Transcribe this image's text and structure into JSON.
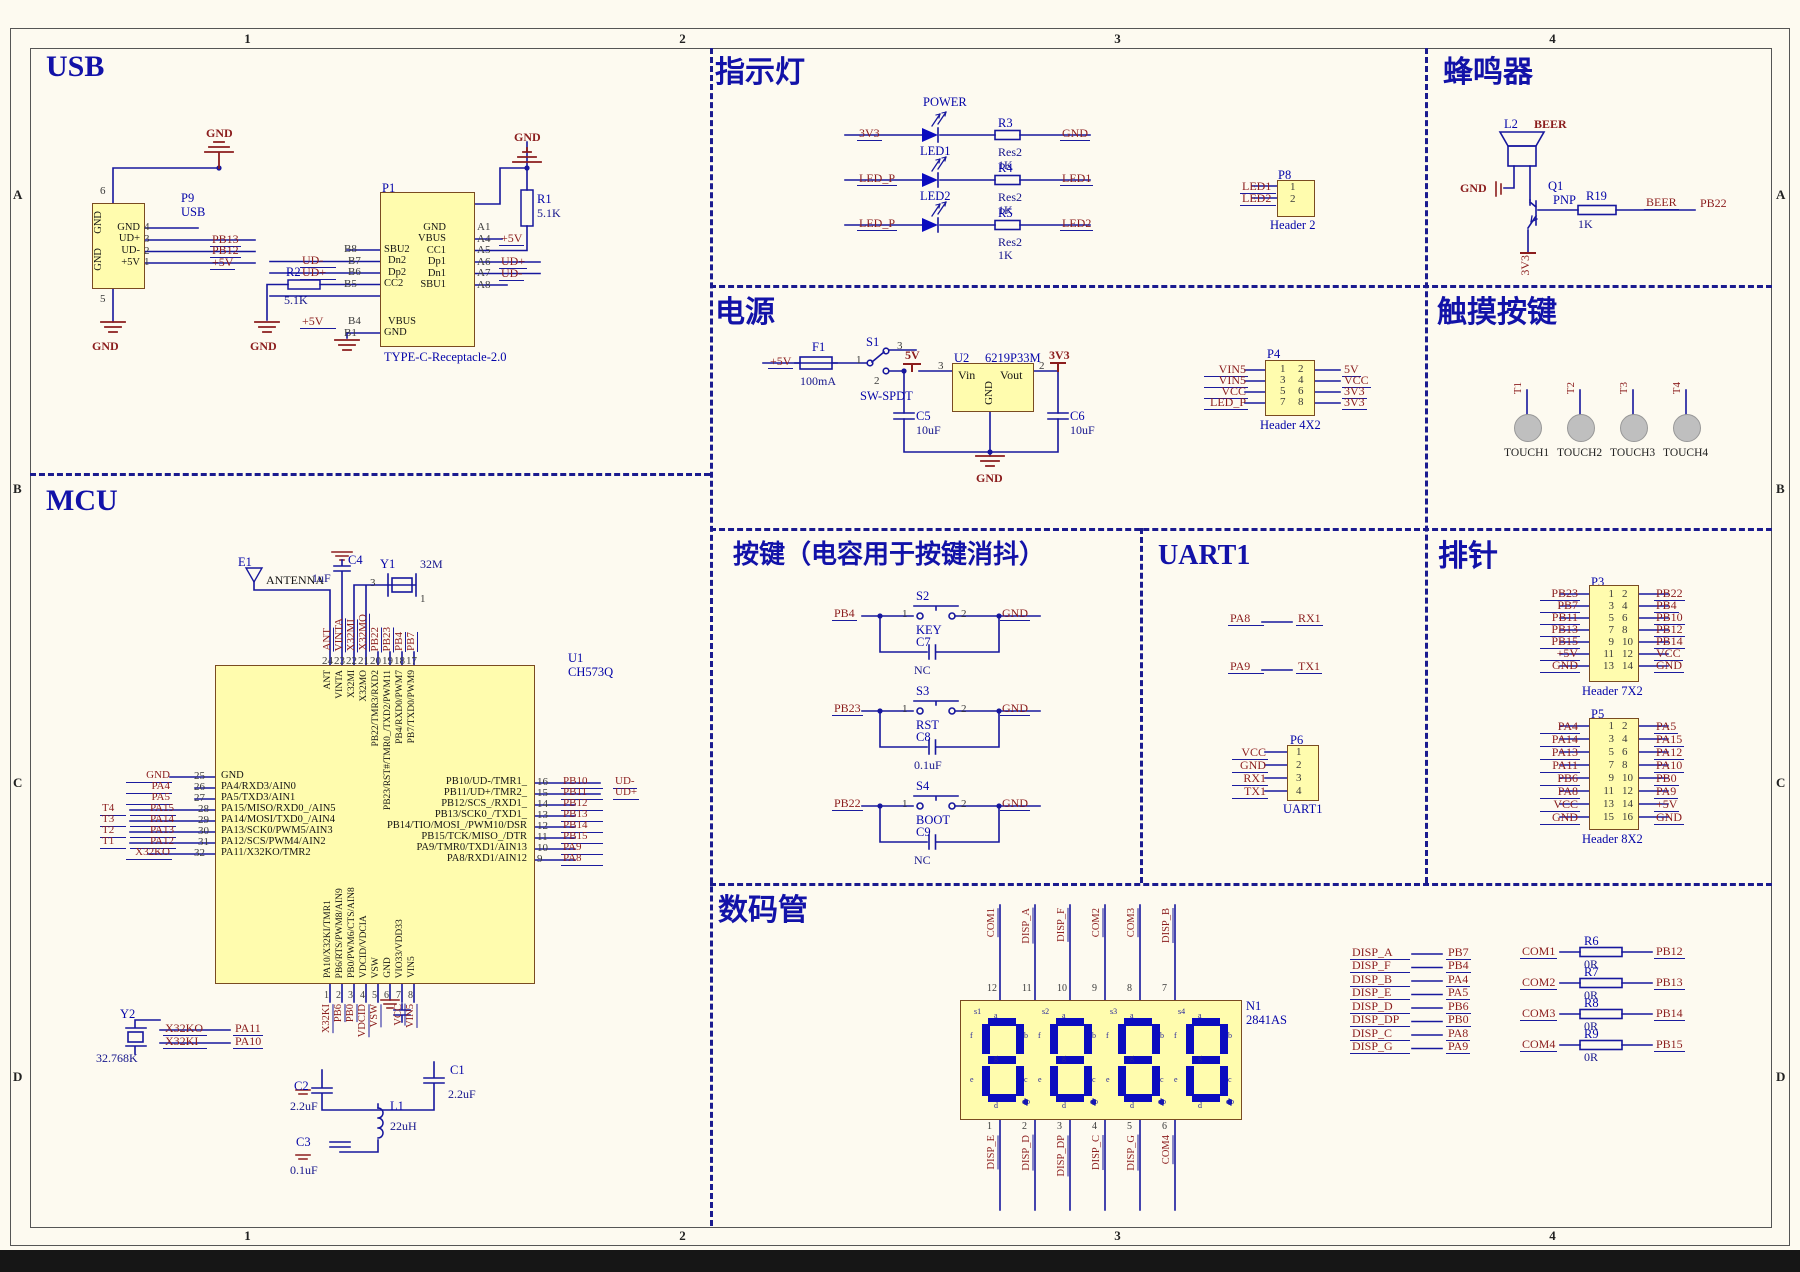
{
  "sheet": {
    "cols": [
      "1",
      "2",
      "3",
      "4"
    ],
    "rows": [
      "A",
      "B",
      "C",
      "D"
    ]
  },
  "usb": {
    "title": "USB",
    "p9": {
      "ref": "P9",
      "name": "USB",
      "pin_top": "6",
      "pin_bottom": "5",
      "side_names": [
        "GND",
        "GND"
      ],
      "rows": [
        {
          "num": "4",
          "pname": "GND",
          "net": ""
        },
        {
          "num": "3",
          "pname": "UD+",
          "net": "PB13"
        },
        {
          "num": "2",
          "pname": "UD-",
          "net": "PB12"
        },
        {
          "num": "1",
          "pname": "+5V",
          "net": "+5V"
        }
      ]
    },
    "gnd": "GND",
    "r2": {
      "ref": "R2",
      "val": "5.1K"
    },
    "r1": {
      "ref": "R1",
      "val": "5.1K"
    },
    "p1": {
      "ref": "P1",
      "footprint": "TYPE-C-Receptacle-2.0",
      "left_rows": [
        {
          "net": "",
          "num": "B8",
          "pname": "SBU2"
        },
        {
          "net": "UD-",
          "num": "B7",
          "pname": "Dn2"
        },
        {
          "net": "UD+",
          "num": "B6",
          "pname": "Dp2"
        },
        {
          "net": "",
          "num": "B5",
          "pname": "CC2"
        },
        {
          "net": "+5V",
          "num": "B4",
          "pname": "VBUS"
        },
        {
          "net": "",
          "num": "B1",
          "pname": "GND"
        }
      ],
      "right_rows": [
        {
          "num": "A1",
          "pname": "GND",
          "net": ""
        },
        {
          "num": "A4",
          "pname": "VBUS",
          "net": "+5V"
        },
        {
          "num": "A5",
          "pname": "CC1",
          "net": ""
        },
        {
          "num": "A6",
          "pname": "Dp1",
          "net": "UD+"
        },
        {
          "num": "A7",
          "pname": "Dn1",
          "net": "UD-"
        },
        {
          "num": "A8",
          "pname": "SBU1",
          "net": ""
        }
      ]
    }
  },
  "indicator": {
    "title": "指示灯",
    "rows": [
      {
        "net_in": "3V3",
        "top_label": "POWER",
        "bot_label": "LED1",
        "res": "R3",
        "res_type": "Res2",
        "res_val": "1K",
        "net_out": "GND"
      },
      {
        "net_in": "LED_P",
        "top_label": "",
        "bot_label": "LED2",
        "res": "R4",
        "res_type": "Res2",
        "res_val": "1K",
        "net_out": "LED1"
      },
      {
        "net_in": "LED_P",
        "top_label": "",
        "bot_label": "",
        "res": "R5",
        "res_type": "Res2",
        "res_val": "1K",
        "net_out": "LED2"
      }
    ],
    "p8": {
      "ref": "P8",
      "label": "Header 2",
      "rows": [
        {
          "net": "LED1",
          "pin": "1"
        },
        {
          "net": "LED2",
          "pin": "2"
        }
      ]
    }
  },
  "buzzer": {
    "title": "蜂鸣器",
    "l2": "L2",
    "l2_net": "BEER",
    "gnd": "GND",
    "q_ref": "Q1",
    "q_type": "PNP",
    "r_ref": "R19",
    "r_val": "1K",
    "net": "BEER",
    "out": "PB22",
    "rail": "3V3"
  },
  "power": {
    "title": "电源",
    "in": "+5V",
    "fuse": {
      "ref": "F1",
      "val": "100mA"
    },
    "sw": {
      "ref": "S1",
      "type": "SW-SPDT",
      "p1": "1",
      "p2": "2",
      "p3": "3"
    },
    "rail5": "5V",
    "rail33": "3V3",
    "u2": {
      "ref": "U2",
      "part": "6219P33M",
      "vin": "Vin",
      "vout": "Vout",
      "gnd": "GND",
      "pin_in": "3",
      "pin_out": "2"
    },
    "c5": {
      "ref": "C5",
      "val": "10uF"
    },
    "c6": {
      "ref": "C6",
      "val": "10uF"
    },
    "gnd": "GND",
    "p4": {
      "ref": "P4",
      "label": "Header 4X2",
      "left": [
        {
          "net": "VIN5",
          "pin": "1"
        },
        {
          "net": "VIN5",
          "pin": "3"
        },
        {
          "net": "VCC",
          "pin": "5"
        },
        {
          "net": "LED_P",
          "pin": "7"
        }
      ],
      "right": [
        {
          "pin": "2",
          "net": "5V"
        },
        {
          "pin": "4",
          "net": "VCC"
        },
        {
          "pin": "6",
          "net": "3V3"
        },
        {
          "pin": "8",
          "net": "3V3"
        }
      ]
    }
  },
  "touch": {
    "title": "触摸按键",
    "pads": [
      {
        "pin": "1",
        "net": "T1",
        "label": "TOUCH1"
      },
      {
        "pin": "1",
        "net": "T2",
        "label": "TOUCH2"
      },
      {
        "pin": "1",
        "net": "T3",
        "label": "TOUCH3"
      },
      {
        "pin": "1",
        "net": "T4",
        "label": "TOUCH4"
      }
    ]
  },
  "mcu": {
    "title": "MCU",
    "u1": {
      "ref": "U1",
      "part": "CH573Q"
    },
    "e1": {
      "ref": "E1",
      "label": "ANTENNA"
    },
    "c4": {
      "ref": "C4",
      "val": "1uF"
    },
    "y1": {
      "ref": "Y1",
      "val": "32M",
      "pa": "3",
      "pb": "1"
    },
    "y2": {
      "ref": "Y2",
      "val": "32.768K"
    },
    "y2_rows": [
      {
        "a": "X32KO",
        "b": "PA11"
      },
      {
        "a": "X32KI",
        "b": "PA10"
      }
    ],
    "c1": {
      "ref": "C1",
      "val": "2.2uF"
    },
    "c2": {
      "ref": "C2",
      "val": "2.2uF"
    },
    "c3": {
      "ref": "C3",
      "val": "0.1uF"
    },
    "l1": {
      "ref": "L1",
      "val": "22uH"
    },
    "top_pins": [
      {
        "num": "24",
        "net": "ANT",
        "pname": "ANT"
      },
      {
        "num": "23",
        "net": "VINTA",
        "pname": "VINTA"
      },
      {
        "num": "22",
        "net": "X32MI",
        "pname": "X32MI"
      },
      {
        "num": "21",
        "net": "X32MO",
        "pname": "X32MO"
      },
      {
        "num": "20",
        "net": "PB22",
        "pname": "PB22/TMR3/RXD2"
      },
      {
        "num": "19",
        "net": "PB23",
        "pname": "PB23/RST#/TMR0_/TXD2/PWM11"
      },
      {
        "num": "18",
        "net": "PB4",
        "pname": "PB4/RXD0/PWM7"
      },
      {
        "num": "17",
        "net": "PB7",
        "pname": "PB7/TXD0/PWM9"
      }
    ],
    "left_pins": [
      {
        "t": "",
        "net": "GND",
        "num": "25",
        "pname": "GND"
      },
      {
        "t": "",
        "net": "PA4",
        "num": "26",
        "pname": "PA4/RXD3/AIN0"
      },
      {
        "t": "",
        "net": "PA5",
        "num": "27",
        "pname": "PA5/TXD3/AIN1"
      },
      {
        "t": "T4",
        "net": "PA15",
        "num": "28",
        "pname": "PA15/MISO/RXD0_/AIN5"
      },
      {
        "t": "T3",
        "net": "PA14",
        "num": "29",
        "pname": "PA14/MOSI/TXD0_/AIN4"
      },
      {
        "t": "T2",
        "net": "PA13",
        "num": "30",
        "pname": "PA13/SCK0/PWM5/AIN3"
      },
      {
        "t": "T1",
        "net": "PA12",
        "num": "31",
        "pname": "PA12/SCS/PWM4/AIN2"
      },
      {
        "t": "",
        "net": "X32KO",
        "num": "32",
        "pname": "PA11/X32KO/TMR2"
      }
    ],
    "right_pins": [
      {
        "num": "16",
        "pname": "PB10/UD-/TMR1_",
        "net": "PB10",
        "extra": "UD-"
      },
      {
        "num": "15",
        "pname": "PB11/UD+/TMR2_",
        "net": "PB11",
        "extra": "UD+"
      },
      {
        "num": "14",
        "pname": "PB12/SCS_/RXD1_",
        "net": "PB12",
        "extra": ""
      },
      {
        "num": "13",
        "pname": "PB13/SCK0_/TXD1_",
        "net": "PB13",
        "extra": ""
      },
      {
        "num": "12",
        "pname": "PB14/TIO/MOSI_/PWM10/DSR",
        "net": "PB14",
        "extra": ""
      },
      {
        "num": "11",
        "pname": "PB15/TCK/MISO_/DTR",
        "net": "PB15",
        "extra": ""
      },
      {
        "num": "10",
        "pname": "PA9/TMR0/TXD1/AIN13",
        "net": "PA9",
        "extra": ""
      },
      {
        "num": "9",
        "pname": "PA8/RXD1/AIN12",
        "net": "PA8",
        "extra": ""
      }
    ],
    "bottom_pins": [
      {
        "num": "1",
        "pname": "PA10/X32KI/TMR1",
        "net": "X32KI"
      },
      {
        "num": "2",
        "pname": "PB6/RTS/PWM8/AIN9",
        "net": "PB6"
      },
      {
        "num": "3",
        "pname": "PB0/PWM6/CTS/AIN8",
        "net": "PB0"
      },
      {
        "num": "4",
        "pname": "VDCID/VDCIA",
        "net": "VDCID"
      },
      {
        "num": "5",
        "pname": "VSW",
        "net": "VSW"
      },
      {
        "num": "6",
        "pname": "GND",
        "net": ""
      },
      {
        "num": "7",
        "pname": "VIO33/VDD33",
        "net": "VCC"
      },
      {
        "num": "8",
        "pname": "VIN5",
        "net": "VIN5"
      }
    ]
  },
  "keys": {
    "title": "按键（电容用于按键消抖）",
    "rows": [
      {
        "net": "PB4",
        "sw": "S2",
        "p1": "1",
        "p2": "2",
        "name": "KEY",
        "cap": "C7",
        "cval": "NC",
        "gnd": "GND"
      },
      {
        "net": "PB23",
        "sw": "S3",
        "p1": "1",
        "p2": "2",
        "name": "RST",
        "cap": "C8",
        "cval": "0.1uF",
        "gnd": "GND"
      },
      {
        "net": "PB22",
        "sw": "S4",
        "p1": "1",
        "p2": "2",
        "name": "BOOT",
        "cap": "C9",
        "cval": "NC",
        "gnd": "GND"
      }
    ]
  },
  "uart": {
    "title": "UART1",
    "rows": [
      {
        "a": "PA8",
        "b": "RX1"
      },
      {
        "a": "PA9",
        "b": "TX1"
      }
    ],
    "p6": {
      "ref": "P6",
      "label": "UART1",
      "rows": [
        {
          "net": "VCC",
          "pin": "1"
        },
        {
          "net": "GND",
          "pin": "2"
        },
        {
          "net": "RX1",
          "pin": "3"
        },
        {
          "net": "TX1",
          "pin": "4"
        }
      ]
    }
  },
  "headers": {
    "title": "排针",
    "p3": {
      "ref": "P3",
      "label": "Header 7X2",
      "rows": [
        {
          "ln": "PB23",
          "lp": "1",
          "rp": "2",
          "rn": "PB22"
        },
        {
          "ln": "PB7",
          "lp": "3",
          "rp": "4",
          "rn": "PB4"
        },
        {
          "ln": "PB11",
          "lp": "5",
          "rp": "6",
          "rn": "PB10"
        },
        {
          "ln": "PB13",
          "lp": "7",
          "rp": "8",
          "rn": "PB12"
        },
        {
          "ln": "PB15",
          "lp": "9",
          "rp": "10",
          "rn": "PB14"
        },
        {
          "ln": "+5V",
          "lp": "11",
          "rp": "12",
          "rn": "VCC"
        },
        {
          "ln": "GND",
          "lp": "13",
          "rp": "14",
          "rn": "GND"
        }
      ]
    },
    "p5": {
      "ref": "P5",
      "label": "Header 8X2",
      "rows": [
        {
          "ln": "PA4",
          "lp": "1",
          "rp": "2",
          "rn": "PA5"
        },
        {
          "ln": "PA14",
          "lp": "3",
          "rp": "4",
          "rn": "PA15"
        },
        {
          "ln": "PA13",
          "lp": "5",
          "rp": "6",
          "rn": "PA12"
        },
        {
          "ln": "PA11",
          "lp": "7",
          "rp": "8",
          "rn": "PA10"
        },
        {
          "ln": "PB6",
          "lp": "9",
          "rp": "10",
          "rn": "PB0"
        },
        {
          "ln": "PA8",
          "lp": "11",
          "rp": "12",
          "rn": "PA9"
        },
        {
          "ln": "VCC",
          "lp": "13",
          "rp": "14",
          "rn": "+5V"
        },
        {
          "ln": "GND",
          "lp": "15",
          "rp": "16",
          "rn": "GND"
        }
      ]
    }
  },
  "display": {
    "title": "数码管",
    "n1": {
      "ref": "N1",
      "part": "2841AS"
    },
    "top_pins": [
      {
        "num": "12",
        "net": "COM1"
      },
      {
        "num": "11",
        "net": "DISP_A"
      },
      {
        "num": "10",
        "net": "DISP_F"
      },
      {
        "num": "9",
        "net": "COM2"
      },
      {
        "num": "8",
        "net": "COM3"
      },
      {
        "num": "7",
        "net": "DISP_B"
      }
    ],
    "bottom_pins": [
      {
        "num": "1",
        "net": "DISP_E"
      },
      {
        "num": "2",
        "net": "DISP_D"
      },
      {
        "num": "3",
        "net": "DISP_DP"
      },
      {
        "num": "4",
        "net": "DISP_C"
      },
      {
        "num": "5",
        "net": "DISP_G"
      },
      {
        "num": "6",
        "net": "COM4"
      }
    ],
    "digits": [
      {
        "name": "s1"
      },
      {
        "name": "s2"
      },
      {
        "name": "s3"
      },
      {
        "name": "s4"
      }
    ],
    "seg_labels": [
      "a",
      "b",
      "c",
      "d",
      "e",
      "f",
      "g",
      "dp"
    ],
    "seg_map": [
      {
        "net": "DISP_A",
        "pin": "PB7"
      },
      {
        "net": "DISP_F",
        "pin": "PB4"
      },
      {
        "net": "DISP_B",
        "pin": "PA4"
      },
      {
        "net": "DISP_E",
        "pin": "PA5"
      },
      {
        "net": "DISP_D",
        "pin": "PB6"
      },
      {
        "net": "DISP_DP",
        "pin": "PB0"
      },
      {
        "net": "DISP_C",
        "pin": "PA8"
      },
      {
        "net": "DISP_G",
        "pin": "PA9"
      }
    ],
    "com_rows": [
      {
        "net": "COM1",
        "res": "R6",
        "val": "0R",
        "pin": "PB12"
      },
      {
        "net": "COM2",
        "res": "R7",
        "val": "0R",
        "pin": "PB13"
      },
      {
        "net": "COM3",
        "res": "R8",
        "val": "0R",
        "pin": "PB14"
      },
      {
        "net": "COM4",
        "res": "R9",
        "val": "0R",
        "pin": "PB15"
      }
    ]
  }
}
